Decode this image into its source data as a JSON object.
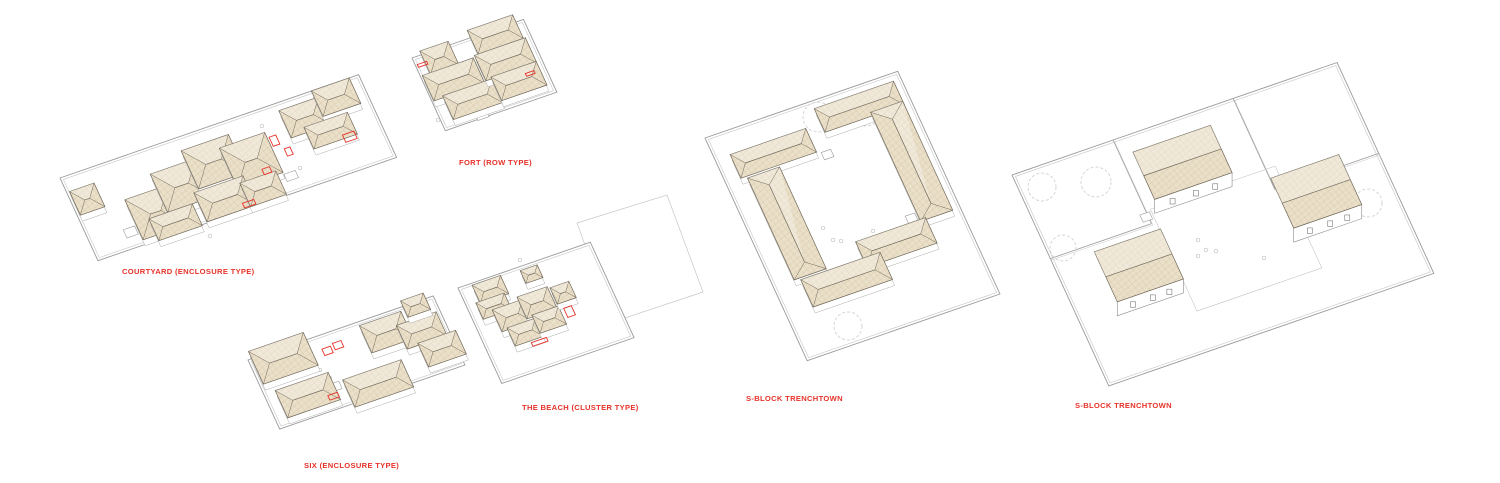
{
  "page": {
    "background": "#ffffff",
    "width": 1500,
    "height": 483
  },
  "colors": {
    "label_red": "#e6332a",
    "accent_red": "#e6332a",
    "roof_fill": "#eadfc8",
    "roof_hatch": "#cfbf9f",
    "roof_outline": "#70685a",
    "wall": "#9a9a9a",
    "wall_light": "#c6c6c6",
    "tree": "#d2d2d2",
    "mark": "#c0c0c0",
    "base": "#ababab",
    "facade": "#8a8a8a"
  },
  "axes": {
    "ux": [
      0.945,
      -0.327
    ],
    "uy": [
      0.417,
      0.909
    ]
  },
  "figures": [
    {
      "id": "courtyard",
      "label": "COURTYARD (ENCLOSURE TYPE)",
      "label_pos": [
        122,
        267
      ],
      "origin": [
        60,
        178
      ],
      "w": 316,
      "h": 91,
      "buildings": [
        [
          3,
          16,
          26,
          26
        ],
        [
          50,
          42,
          46,
          44
        ],
        [
          84,
          26,
          48,
          42
        ],
        [
          122,
          14,
          50,
          42
        ],
        [
          158,
          24,
          48,
          44
        ],
        [
          64,
          68,
          46,
          24
        ],
        [
          116,
          58,
          52,
          32
        ],
        [
          162,
          64,
          38,
          26
        ],
        [
          228,
          8,
          42,
          30
        ],
        [
          266,
          0,
          40,
          28
        ],
        [
          244,
          32,
          46,
          24
        ]
      ],
      "boxes": [
        [
          36,
          70,
          12,
          9
        ],
        [
          206,
          70,
          12,
          8
        ]
      ],
      "reds": [
        [
          208,
          30,
          7,
          10
        ],
        [
          217,
          46,
          6,
          8
        ],
        [
          156,
          84,
          12,
          5
        ],
        [
          276,
          52,
          12,
          8
        ],
        [
          188,
          58,
          8,
          6
        ]
      ],
      "marks": [
        [
          152,
          200
        ],
        [
          262,
          126
        ],
        [
          300,
          168
        ],
        [
          210,
          236
        ]
      ],
      "trees": [],
      "dividers": [],
      "free_polys": []
    },
    {
      "id": "fort",
      "label": "FORT (ROW TYPE)",
      "label_pos": [
        459,
        158
      ],
      "origin": [
        412,
        58
      ],
      "w": 118,
      "h": 80,
      "buildings": [
        [
          10,
          -4,
          30,
          26
        ],
        [
          2,
          20,
          54,
          28
        ],
        [
          12,
          46,
          52,
          26
        ],
        [
          62,
          -8,
          48,
          26
        ],
        [
          58,
          18,
          54,
          28
        ],
        [
          64,
          44,
          48,
          26
        ]
      ],
      "boxes": [
        [
          98,
          56,
          14,
          11
        ],
        [
          34,
          72,
          12,
          9
        ]
      ],
      "reds": [
        [
          2,
          8,
          10,
          3
        ],
        [
          97,
          52,
          9,
          3
        ]
      ],
      "marks": [
        [
          438,
          120
        ]
      ],
      "trees": [],
      "dividers": [],
      "free_polys": []
    },
    {
      "id": "six",
      "label": "SIX (ENCLOSURE TYPE)",
      "label_pos": [
        304,
        461
      ],
      "origin": [
        248,
        360
      ],
      "w": 196,
      "h": 76,
      "buildings": [
        [
          4,
          -8,
          58,
          36
        ],
        [
          12,
          38,
          56,
          30
        ],
        [
          78,
          50,
          62,
          30
        ],
        [
          116,
          4,
          44,
          30
        ],
        [
          150,
          16,
          42,
          26
        ],
        [
          164,
          -6,
          24,
          18
        ],
        [
          162,
          40,
          40,
          26
        ]
      ],
      "boxes": [
        [
          64,
          50,
          10,
          8
        ]
      ],
      "reds": [
        [
          72,
          14,
          9,
          7
        ],
        [
          84,
          12,
          9,
          7
        ],
        [
          58,
          60,
          10,
          5
        ]
      ],
      "marks": [
        [
          320,
          370
        ],
        [
          330,
          378
        ]
      ],
      "trees": [],
      "dividers": [],
      "free_polys": []
    },
    {
      "id": "beach",
      "label": "THE BEACH (CLUSTER TYPE)",
      "label_pos": [
        522,
        403
      ],
      "origin": [
        458,
        288
      ],
      "w": 140,
      "h": 105,
      "buildings": [
        [
          14,
          2,
          30,
          20
        ],
        [
          10,
          20,
          30,
          18
        ],
        [
          64,
          4,
          18,
          14
        ],
        [
          22,
          32,
          32,
          24
        ],
        [
          50,
          28,
          32,
          24
        ],
        [
          28,
          54,
          30,
          20
        ],
        [
          56,
          50,
          28,
          20
        ],
        [
          84,
          30,
          20,
          18
        ]
      ],
      "boxes": [],
      "reds": [
        [
          88,
          54,
          8,
          10
        ],
        [
          44,
          76,
          16,
          4
        ]
      ],
      "marks": [
        [
          520,
          260
        ],
        [
          545,
          300
        ]
      ],
      "trees": [],
      "dividers": [],
      "free_polys": [
        {
          "points": [
            [
              577,
              223
            ],
            [
              667,
              195
            ],
            [
              703,
              292
            ],
            [
              613,
              322
            ]
          ],
          "closed": true
        },
        {
          "points": [
            [
              588,
              300
            ],
            [
              601,
              289
            ],
            [
              597,
              307
            ],
            [
              613,
              303
            ],
            [
              606,
              317
            ]
          ],
          "closed": false
        }
      ]
    },
    {
      "id": "sblock-1",
      "label": "S-BLOCK TRENCHTOWN",
      "label_pos": [
        746,
        394
      ],
      "origin": [
        705,
        138
      ],
      "w": 204,
      "h": 245,
      "hip": true,
      "buildings": [
        [
          16,
          24,
          80,
          26
        ],
        [
          112,
          8,
          84,
          26
        ],
        [
          162,
          30,
          34,
          120
        ],
        [
          94,
          148,
          74,
          28
        ],
        [
          22,
          52,
          34,
          112
        ],
        [
          28,
          166,
          84,
          30
        ]
      ],
      "boxes": [
        [
          100,
          52,
          10,
          8
        ],
        [
          70,
          186,
          10,
          8
        ],
        [
          150,
          140,
          10,
          8
        ]
      ],
      "reds": [],
      "marks": [
        [
          823,
          228
        ],
        [
          833,
          240
        ],
        [
          841,
          241
        ],
        [
          873,
          231
        ]
      ],
      "trees": [
        [
          818,
          117,
          15
        ],
        [
          866,
          110,
          16
        ],
        [
          848,
          326,
          14
        ]
      ],
      "dividers": [],
      "free_polys": []
    },
    {
      "id": "sblock-2",
      "label": "S-BLOCK TRENCHTOWN",
      "label_pos": [
        1075,
        401
      ],
      "origin": [
        1012,
        175
      ],
      "w": 344,
      "h": 232,
      "tall": true,
      "buildings": [
        [
          120,
          18,
          82,
          52
        ],
        [
          235,
          88,
          72,
          55
        ],
        [
          43,
          100,
          70,
          55
        ]
      ],
      "plaza": [
        112,
        78,
        132,
        112
      ],
      "boxes": [
        [
          100,
          80,
          10,
          8
        ],
        [
          60,
          160,
          10,
          8
        ]
      ],
      "reds": [],
      "marks": [
        [
          1198,
          240
        ],
        [
          1206,
          250
        ],
        [
          1216,
          251
        ],
        [
          1198,
          256
        ],
        [
          1264,
          258
        ]
      ],
      "trees": [
        [
          1042,
          187,
          14
        ],
        [
          1096,
          182,
          15
        ],
        [
          1063,
          248,
          13
        ],
        [
          1368,
          203,
          14
        ]
      ],
      "dividers": [
        [
          107,
          0,
          107,
          92
        ],
        [
          107,
          92,
          0,
          92
        ],
        [
          234,
          0,
          234,
          100
        ],
        [
          234,
          100,
          344,
          100
        ]
      ],
      "free_polys": []
    }
  ]
}
